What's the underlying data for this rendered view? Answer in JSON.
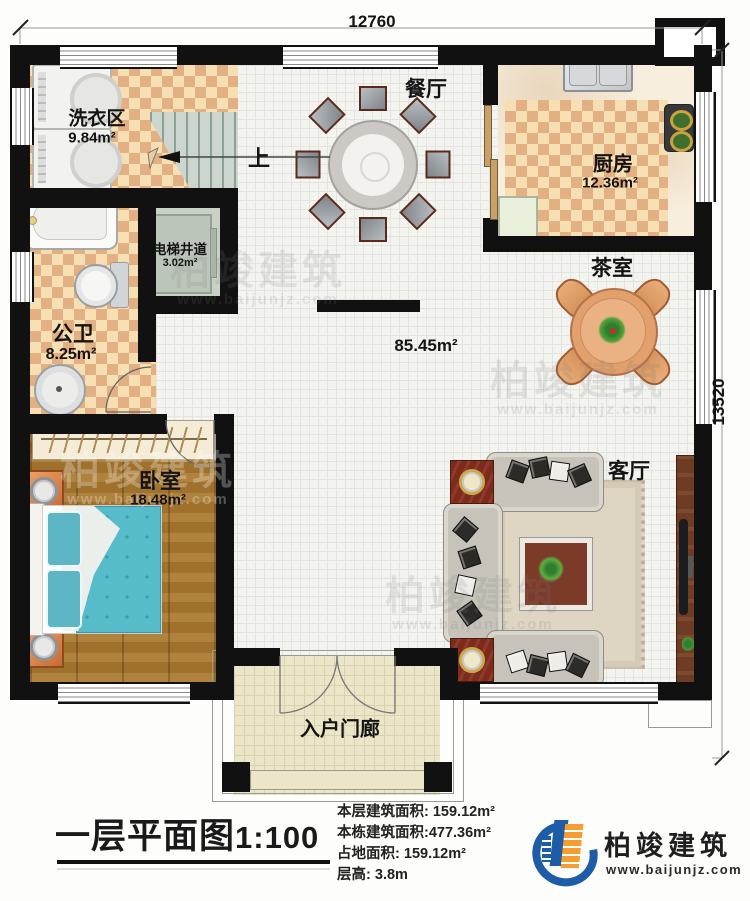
{
  "plan": {
    "dimensions": {
      "top_width": "12760",
      "right_height": "13520"
    },
    "hall_area": "85.45m²",
    "stairs_direction": "上",
    "rooms": {
      "laundry": {
        "name": "洗衣区",
        "area": "9.84m²"
      },
      "dining": {
        "name": "餐厅"
      },
      "kitchen": {
        "name": "厨房",
        "area": "12.36m²"
      },
      "tea": {
        "name": "茶室"
      },
      "elevator": {
        "name": "电梯井道",
        "area": "3.02m²"
      },
      "bathroom": {
        "name": "公卫",
        "area": "8.25m²"
      },
      "bedroom": {
        "name": "卧室",
        "area": "18.48m²"
      },
      "living": {
        "name": "客厅"
      },
      "porch": {
        "name": "入户门廊"
      }
    }
  },
  "footer": {
    "title": "一层平面图",
    "scale": "1:100",
    "stats": [
      {
        "label": "本层建筑面积:",
        "value": "159.12m²"
      },
      {
        "label": "本栋建筑面积:",
        "value": "477.36m²"
      },
      {
        "label": "占地面积:",
        "value": "159.12m²"
      },
      {
        "label": "层高:",
        "value": "3.8m"
      }
    ],
    "logo": {
      "name": "柏竣建筑",
      "url": "www.baijunjz.com"
    }
  },
  "watermark": {
    "name": "柏竣建筑",
    "url": "www.baijunjz.com"
  },
  "colors": {
    "wall": "#111111",
    "checker": "#e2b083",
    "wood": "#a9782f",
    "bed": "#57bcca",
    "logo_blue": "#1d5ca6",
    "logo_orange": "#f59d2f"
  }
}
